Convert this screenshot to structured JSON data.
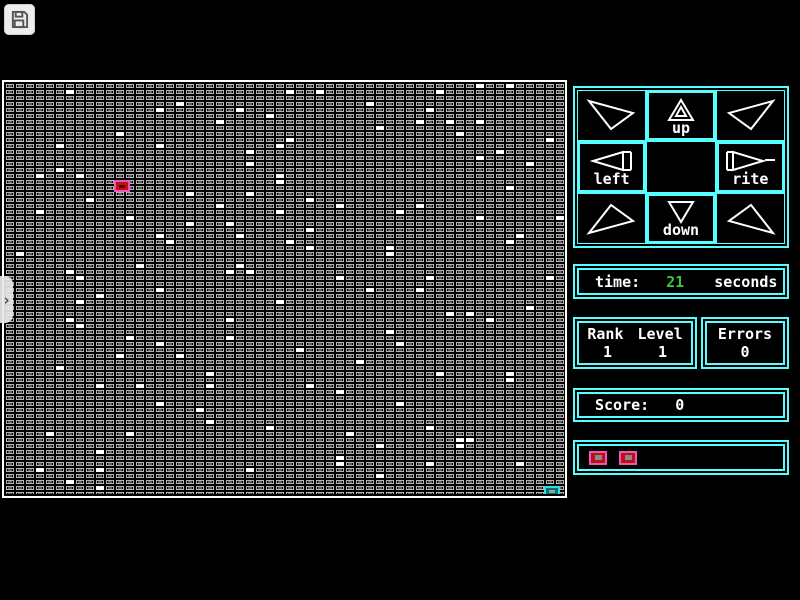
{
  "colors": {
    "panel_cyan": "#55ffff",
    "time_green": "#3cc43c",
    "cursor_pink": "#ee55bb",
    "cursor_red": "#bb1111",
    "cell_gray": "#b4b4b4",
    "exit_teal": "#33dddd"
  },
  "toolbar": {
    "save_icon": "save"
  },
  "side_tab": {
    "chevron": "›"
  },
  "dirpad": {
    "up": "up",
    "left": "left",
    "rite": "rite",
    "down": "down"
  },
  "time_panel": {
    "label": "time:",
    "value": "21",
    "unit": "seconds"
  },
  "rank_panel": {
    "rank_label": "Rank",
    "level_label": "Level",
    "rank": "1",
    "level": "1"
  },
  "errors_panel": {
    "label": "Errors",
    "value": "0"
  },
  "score_panel": {
    "label": "Score:",
    "value": "0"
  },
  "board": {
    "cols": 56,
    "rows": 68,
    "cell_w": 10,
    "cell_h": 6,
    "dot_w": 8,
    "dot_h": 4,
    "cursor": {
      "col": 11,
      "row": 16
    },
    "exit": {
      "col": 54,
      "row": 67
    },
    "dots": [
      [
        6,
        1
      ],
      [
        17,
        3
      ],
      [
        15,
        4
      ],
      [
        11,
        8
      ],
      [
        5,
        10
      ],
      [
        15,
        10
      ],
      [
        5,
        14
      ],
      [
        3,
        15
      ],
      [
        7,
        15
      ],
      [
        8,
        19
      ],
      [
        18,
        18
      ],
      [
        3,
        21
      ],
      [
        12,
        22
      ],
      [
        28,
        1
      ],
      [
        31,
        1
      ],
      [
        36,
        3
      ],
      [
        23,
        4
      ],
      [
        26,
        5
      ],
      [
        21,
        6
      ],
      [
        37,
        7
      ],
      [
        28,
        9
      ],
      [
        27,
        10
      ],
      [
        24,
        11
      ],
      [
        24,
        13
      ],
      [
        27,
        15
      ],
      [
        27,
        16
      ],
      [
        24,
        18
      ],
      [
        30,
        19
      ],
      [
        21,
        20
      ],
      [
        33,
        20
      ],
      [
        27,
        21
      ],
      [
        22,
        23
      ],
      [
        43,
        1
      ],
      [
        47,
        0
      ],
      [
        50,
        0
      ],
      [
        42,
        4
      ],
      [
        41,
        6
      ],
      [
        44,
        6
      ],
      [
        47,
        6
      ],
      [
        45,
        8
      ],
      [
        54,
        9
      ],
      [
        49,
        11
      ],
      [
        47,
        12
      ],
      [
        52,
        13
      ],
      [
        50,
        17
      ],
      [
        41,
        20
      ],
      [
        39,
        21
      ],
      [
        47,
        22
      ],
      [
        55,
        22
      ],
      [
        18,
        23
      ],
      [
        15,
        25
      ],
      [
        16,
        26
      ],
      [
        1,
        28
      ],
      [
        13,
        30
      ],
      [
        6,
        31
      ],
      [
        7,
        32
      ],
      [
        15,
        34
      ],
      [
        9,
        35
      ],
      [
        7,
        36
      ],
      [
        6,
        39
      ],
      [
        7,
        40
      ],
      [
        12,
        42
      ],
      [
        15,
        43
      ],
      [
        11,
        45
      ],
      [
        30,
        24
      ],
      [
        23,
        25
      ],
      [
        28,
        26
      ],
      [
        30,
        27
      ],
      [
        23,
        30
      ],
      [
        22,
        31
      ],
      [
        24,
        31
      ],
      [
        33,
        32
      ],
      [
        36,
        34
      ],
      [
        27,
        36
      ],
      [
        22,
        39
      ],
      [
        22,
        42
      ],
      [
        29,
        44
      ],
      [
        51,
        25
      ],
      [
        50,
        26
      ],
      [
        38,
        27
      ],
      [
        38,
        28
      ],
      [
        42,
        32
      ],
      [
        54,
        32
      ],
      [
        41,
        34
      ],
      [
        52,
        37
      ],
      [
        44,
        38
      ],
      [
        46,
        38
      ],
      [
        48,
        39
      ],
      [
        38,
        41
      ],
      [
        39,
        43
      ],
      [
        5,
        47
      ],
      [
        17,
        45
      ],
      [
        9,
        50
      ],
      [
        13,
        50
      ],
      [
        15,
        53
      ],
      [
        4,
        58
      ],
      [
        12,
        58
      ],
      [
        9,
        61
      ],
      [
        3,
        64
      ],
      [
        9,
        64
      ],
      [
        6,
        66
      ],
      [
        9,
        67
      ],
      [
        35,
        46
      ],
      [
        20,
        48
      ],
      [
        20,
        50
      ],
      [
        30,
        50
      ],
      [
        33,
        51
      ],
      [
        19,
        54
      ],
      [
        20,
        56
      ],
      [
        26,
        57
      ],
      [
        34,
        58
      ],
      [
        37,
        60
      ],
      [
        33,
        62
      ],
      [
        33,
        63
      ],
      [
        24,
        64
      ],
      [
        37,
        65
      ],
      [
        43,
        48
      ],
      [
        50,
        48
      ],
      [
        50,
        49
      ],
      [
        39,
        53
      ],
      [
        42,
        57
      ],
      [
        45,
        59
      ],
      [
        46,
        59
      ],
      [
        45,
        60
      ],
      [
        42,
        63
      ],
      [
        51,
        63
      ]
    ]
  }
}
